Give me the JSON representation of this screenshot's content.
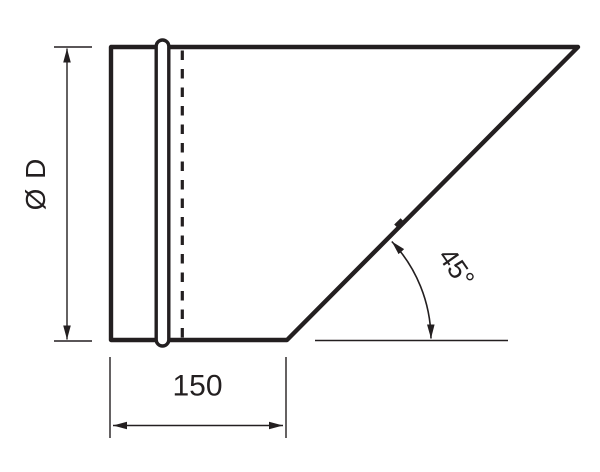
{
  "diagram": {
    "labels": {
      "diameter": "Ø D",
      "length": "150",
      "angle": "45°"
    },
    "colors": {
      "line": "#231f20",
      "background": "#ffffff"
    }
  }
}
